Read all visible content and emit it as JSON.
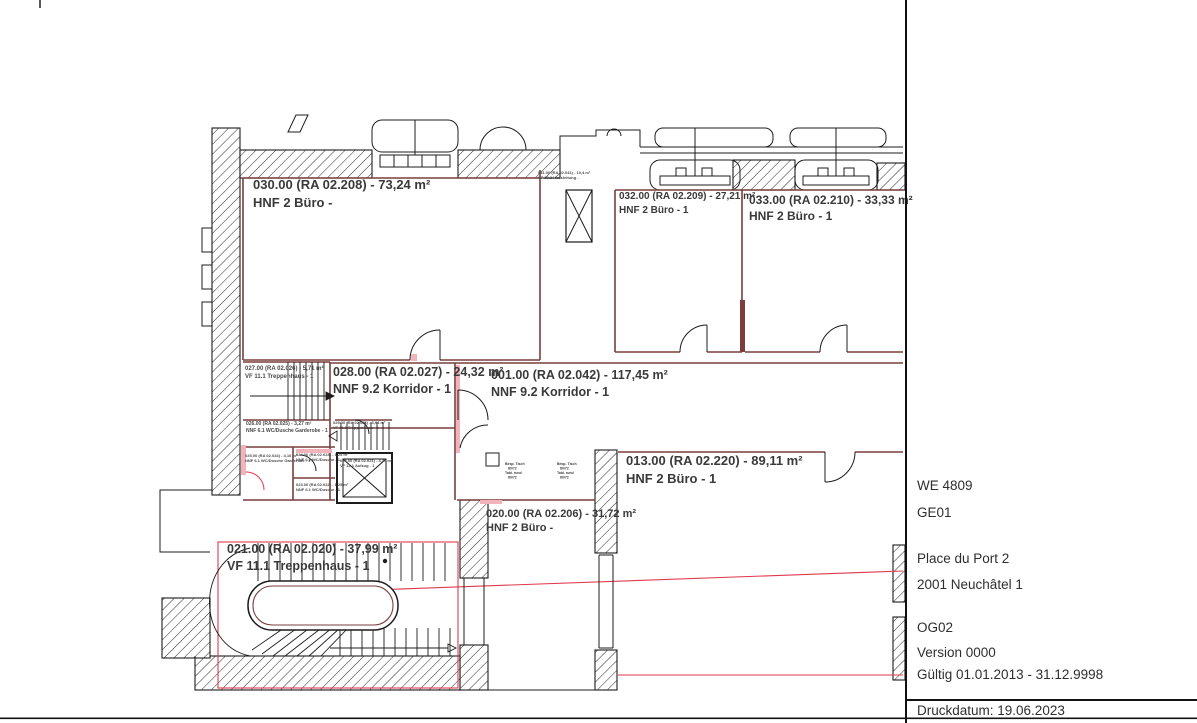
{
  "title_block": {
    "we": "WE 4809",
    "ge": "GE01",
    "address_line1": "Place du Port 2",
    "address_line2": "2001 Neuchâtel 1",
    "floor": "OG02",
    "version": "Version 0000",
    "validity": "Gültig 01.01.2013 - 31.12.9998",
    "print_date": "Druckdatum: 19.06.2023"
  },
  "rooms": {
    "r030": {
      "line1": "030.00 (RA 02.208) - 73,24 m²",
      "line2": "HNF 2 Büro -"
    },
    "r031": {
      "line1": "031.00 (RA 02.041) - 10,4 m²",
      "line2": "VF 10.2 Hausleitung -"
    },
    "r032": {
      "line1": "032.00 (RA 02.209) - 27,21 m²",
      "line2": "HNF 2 Büro - 1"
    },
    "r033": {
      "line1": "033.00 (RA 02.210) - 33,33 m²",
      "line2": "HNF 2 Büro - 1"
    },
    "r027": {
      "line1": "027.00 (RA 02.026) - 5,71 m²",
      "line2": "VF 11.1 Treppenhaus - 1"
    },
    "r028": {
      "line1": "028.00 (RA 02.027) - 24,32 m²",
      "line2": "NNF 9.2 Korridor - 1"
    },
    "r001": {
      "line1": "001.00 (RA 02.042) - 117,45 m²",
      "line2": "NNF 9.2 Korridor - 1"
    },
    "r026": {
      "line1": "026.00 (RA 02.025) - 3,27 m²",
      "line2": "NNF 6.1 WC/Dusche Garderobe - 1"
    },
    "r029": {
      "line1": "029.00 (RA 02.028) - 3,94 m²",
      "line2": "VF 11.1 Treppenhaus - 1"
    },
    "r025": {
      "line1": "025.00 (RA 02.024) - 4,16 m²",
      "line2": "NNF 6.1 WC/Dusche Garderobe - 1"
    },
    "r024": {
      "line1": "024.00 (RA 02.023) - 1,25 m²",
      "line2": "NNF 6.1 WC/Dusche - 1"
    },
    "r023": {
      "line1": "023.00 (RA 02.022) - 1,25 m²",
      "line2": "NNF 6.1 WC/Dusche - 1"
    },
    "r022": {
      "line1": "022.00 (RA 02.021) - 4,30 m²",
      "line2": "VF 12.1 Aufzug - 1"
    },
    "r020": {
      "line1": "020.00 (RA 02.206) - 31,72 m²",
      "line2": "HNF 2 Büro -"
    },
    "r013": {
      "line1": "013.00 (RA 02.220) - 89,11 m²",
      "line2": "HNF 2 Büro - 1"
    },
    "r021": {
      "line1": "021.00 (RA 02.020) - 37,99 m²",
      "line2": "VF 11.1 Treppenhaus - 1"
    }
  },
  "furniture": {
    "lines": [
      "Besp. Tisch",
      "80/72",
      "Tabl. rund",
      "80/72"
    ]
  },
  "colors": {
    "wall_line": "#1c1c1c",
    "room_boundary": "#7a3e3e",
    "accent_red": "#e0394e",
    "accent_pink": "#f2b3ba"
  }
}
